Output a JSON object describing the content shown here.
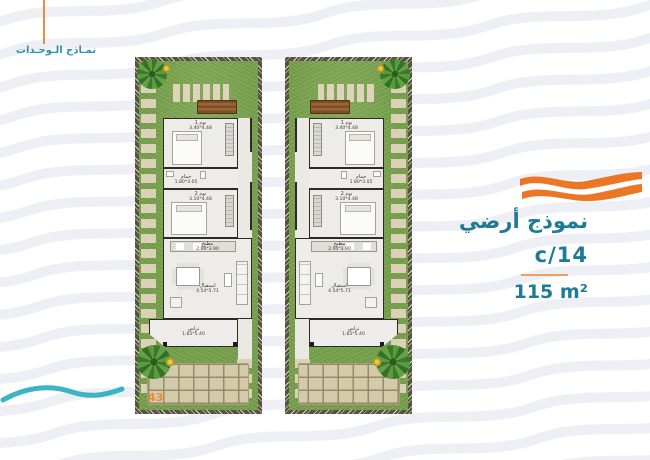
{
  "page": {
    "number": "43"
  },
  "header": {
    "section_label": "نمـاذج الـوحـدات"
  },
  "info": {
    "title": "نموذج أرضي",
    "code": "c/14",
    "area": "115 m²"
  },
  "colors": {
    "accent_orange": "#ec7623",
    "teal_text": "#1e7b97",
    "footer_wave_teal": "#3cb4c6",
    "grass_green": "#78a24d",
    "wall_dark": "#2b2b27",
    "stone_beige": "#d8cfb3",
    "floor_gray": "#edece8",
    "bg_wave_gray": "#edeff4"
  },
  "plans": [
    {
      "name": "unit-plan-left",
      "rooms": {
        "bedroom1": {
          "label": "نوم 1",
          "dims": "3.40*4.48"
        },
        "bathroom": {
          "label": "حمام",
          "dims": "1.80*3.05"
        },
        "bedroom2": {
          "label": "نوم 2",
          "dims": "3.10*4.48"
        },
        "kitchen": {
          "label": "مطبخ",
          "dims": "2.00*3.90"
        },
        "reception": {
          "label": "استقبال",
          "dims": "4.54*5.71"
        },
        "terrace": {
          "label": "تراس",
          "dims": "1.65*5.40"
        }
      }
    },
    {
      "name": "unit-plan-right",
      "rooms": {
        "bedroom1": {
          "label": "نوم 1",
          "dims": "3.40*4.48"
        },
        "bathroom": {
          "label": "حمام",
          "dims": "1.80*3.05"
        },
        "bedroom2": {
          "label": "نوم 2",
          "dims": "3.10*4.48"
        },
        "kitchen": {
          "label": "مطبخ",
          "dims": "2.00*3.90"
        },
        "reception": {
          "label": "استقبال",
          "dims": "4.54*5.71"
        },
        "terrace": {
          "label": "تراس",
          "dims": "1.65*5.40"
        }
      }
    }
  ]
}
